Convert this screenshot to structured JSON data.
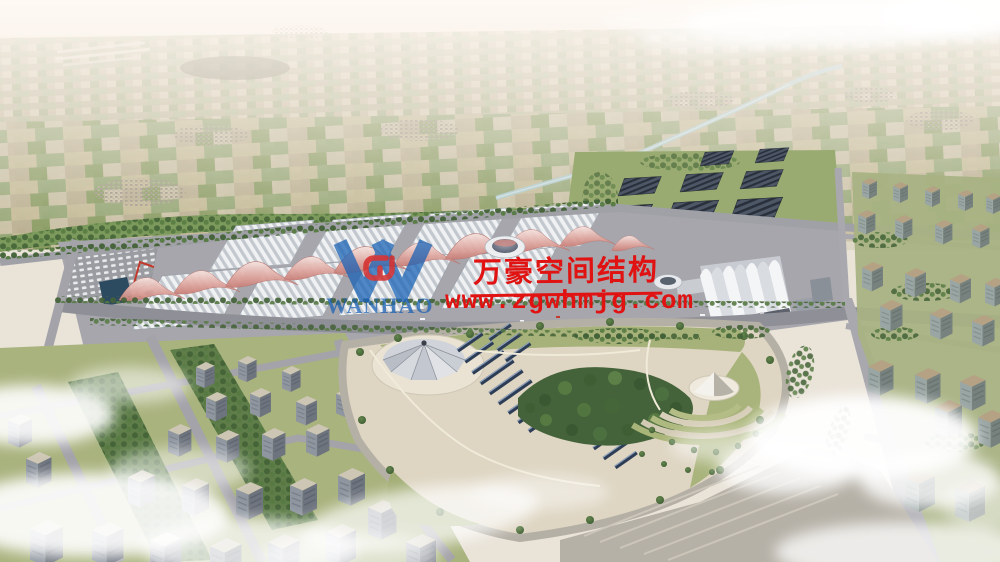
{
  "image": {
    "alt": "Aerial architectural rendering of a large exhibition center with white vaulted halls and pink wave-form membrane roofs, a central park with tent cone and solar panel rows, surrounding residential blocks, a solar-shed farm, a river and hazy farmland horizon, partly covered by clouds"
  },
  "watermark": {
    "company_cn": "万豪空间结构",
    "website": "www.zgwhmjg.com",
    "logo_text": "WANHAO",
    "text_color": "#e01212",
    "logo_blue": "#1b63b5",
    "logo_mark_red": "#d42424"
  },
  "palette": {
    "sky_haze": "#f3ede6",
    "farmland_tan": "#c6ba9d",
    "farmland_green": "#8ba06b",
    "tree_dark": "#3f5e33",
    "hall_roof_white": "#eff1f3",
    "membrane_pink": "#cf8b84",
    "solar_shed_slate": "#4d5766",
    "park_panel_blue": "#2e3d56",
    "road_gray": "#9b9ba1",
    "plaza_beige": "#ded5c2",
    "river_blue": "#a9c9cf",
    "cloud_white": "#ffffff"
  }
}
